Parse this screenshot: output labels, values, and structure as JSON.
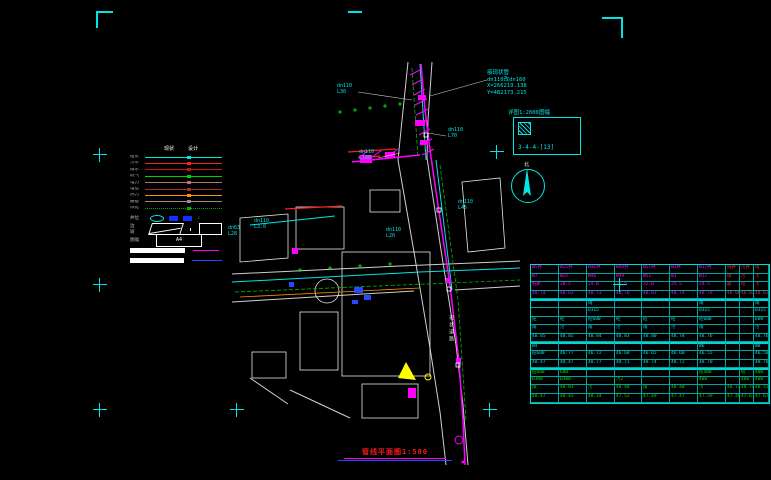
{
  "title": {
    "text": "管线平面图1:500"
  },
  "survey_note": {
    "text": "接现状管\ndn110改dn160\nX=266219.138\nY=482173.215",
    "x": 487,
    "y": 70
  },
  "detail_box": {
    "label": "详图1:2000图幅",
    "code": "3-4-4-[13]"
  },
  "north": {
    "label": "北"
  },
  "colors": {
    "accent": "#00e5e5",
    "pipe_new": "#ff00ff",
    "pipe_existing": "#00e5e5",
    "storm": "#ff2020",
    "green_dashed": "#00b400",
    "table_border": "#00d8d8"
  },
  "annotations": [
    {
      "text": "dn110\nL30",
      "x": 337,
      "y": 84
    },
    {
      "text": "dn110\nL70",
      "x": 448,
      "y": 128
    },
    {
      "text": "dn110\nL190",
      "x": 359,
      "y": 150
    },
    {
      "text": "dn110\nL3.0",
      "x": 254,
      "y": 219
    },
    {
      "text": "dn63\nL28",
      "x": 228,
      "y": 226
    },
    {
      "text": "dn110\nL20",
      "x": 386,
      "y": 228
    },
    {
      "text": "dn110\nL45",
      "x": 458,
      "y": 200
    }
  ],
  "crosses": [
    [
      100,
      155
    ],
    [
      100,
      285
    ],
    [
      100,
      410
    ],
    [
      237,
      410
    ],
    [
      490,
      410
    ],
    [
      620,
      285
    ],
    [
      497,
      152
    ]
  ],
  "road_name": "现状道路",
  "legend": {
    "header": [
      "现状",
      "设计"
    ],
    "line_rows": [
      {
        "label": "给水",
        "color": "#00e5e5",
        "dashed": false
      },
      {
        "label": "污水",
        "color": "#ff2020",
        "dashed": false
      },
      {
        "label": "雨水",
        "color": "#d01010",
        "dashed": false
      },
      {
        "label": "燃气",
        "color": "#00d000",
        "dashed": false
      },
      {
        "label": "电力",
        "color": "#c07070",
        "dashed": false
      },
      {
        "label": "电信",
        "color": "#a03030",
        "dashed": false
      },
      {
        "label": "热力",
        "color": "#ff9000",
        "dashed": false
      },
      {
        "label": "路基",
        "color": "#909090",
        "dashed": false
      },
      {
        "label": "绿化",
        "color": "#00b000",
        "dashed": true
      }
    ],
    "well_row_label": "井位",
    "slope_row_label": "边坡",
    "sheet_row_label": "图幅",
    "a4_label": "A4"
  },
  "table": {
    "cols": [
      28,
      28,
      28,
      27,
      28,
      28,
      28,
      14,
      14,
      15
    ],
    "rows": [
      {
        "k": "m",
        "redFrom": 7,
        "sep": false,
        "cells": [
          "W5井",
          "W25井",
          "W46井",
          "W49井",
          "W51井",
          "W3井",
          "W17井",
          "雨井",
          "污井",
          "雨"
        ]
      },
      {
        "k": "m",
        "redFrom": 7,
        "sep": false,
        "cells": [
          "W7",
          "W25",
          "W46",
          "W49",
          "W51",
          "W3",
          "W17",
          "雨",
          "污",
          "污"
        ]
      },
      {
        "k": "m",
        "redFrom": 7,
        "sep": false,
        "cells": [
          "桩距",
          "28.5",
          "24.0",
          "26.5",
          "22.0",
          "25.5",
          "24.5",
          "最",
          "砼",
          "污"
        ]
      },
      {
        "k": "m",
        "redFrom": 7,
        "sep": false,
        "cells": [
          "48.74",
          "48.63",
          "48.73",
          "48.76",
          "48.81",
          "48.74",
          "48.79",
          "48.08",
          "46.02",
          "48.02"
        ]
      },
      {
        "k": "c",
        "redFrom": -1,
        "sep": true,
        "cells": [
          "",
          "",
          "雨",
          "",
          "",
          "",
          "雨",
          "",
          "",
          "雨"
        ]
      },
      {
        "k": "c",
        "redFrom": -1,
        "sep": false,
        "cells": [
          "",
          "",
          "D315",
          "",
          "",
          "",
          "D315",
          "",
          "",
          "D315"
        ]
      },
      {
        "k": "c",
        "redFrom": -1,
        "sep": false,
        "cells": [
          "砼",
          "砼",
          "砼600",
          "砼",
          "砼",
          "砼",
          "砼600",
          "",
          "",
          "600"
        ]
      },
      {
        "k": "c",
        "redFrom": -1,
        "sep": false,
        "cells": [
          "雨",
          "污",
          "雨",
          "污",
          "雨",
          "污",
          "雨",
          "",
          "",
          "污"
        ]
      },
      {
        "k": "c",
        "redFrom": -1,
        "sep": false,
        "cells": [
          "48.85",
          "48.85",
          "48.84",
          "48.83",
          "48.80",
          "48.78",
          "48.76",
          "",
          "",
          "48.76"
        ]
      },
      {
        "k": "c",
        "redFrom": -1,
        "sep": true,
        "cells": [
          "W4",
          "",
          "",
          "",
          "",
          "",
          "W6",
          "",
          "",
          "W8"
        ]
      },
      {
        "k": "c",
        "redFrom": -1,
        "sep": false,
        "cells": [
          "砼600",
          "46.77",
          "46.72",
          "46.68",
          "46.65",
          "46.60",
          "46.55",
          "",
          "",
          "46.50"
        ]
      },
      {
        "k": "c",
        "redFrom": -1,
        "sep": false,
        "cells": [
          "48.47",
          "48.47",
          "48.77",
          "48.71",
          "48.74",
          "48.72",
          "48.70",
          "",
          "",
          "48.70"
        ]
      },
      {
        "k": "g",
        "redFrom": -1,
        "sep": true,
        "cells": [
          "砼600",
          "600",
          "",
          "",
          "",
          "",
          "砼400",
          "",
          "砼",
          "400"
        ]
      },
      {
        "k": "g",
        "redFrom": -1,
        "sep": false,
        "cells": [
          "D300",
          "D300",
          "",
          "污2",
          "",
          "",
          "400",
          "",
          "400",
          "400"
        ]
      },
      {
        "k": "g",
        "redFrom": -1,
        "sep": false,
        "cells": [
          "雨",
          "48.03",
          "污",
          "48.48",
          "雨",
          "48.40",
          "污",
          "48.72",
          "48.74",
          "48.72"
        ]
      },
      {
        "k": "g",
        "redFrom": -1,
        "sep": false,
        "cells": [
          "48.47",
          "48.42",
          "48.34",
          "47.52",
          "47.49",
          "47.47",
          "47.59",
          "47.46",
          "47.67",
          "47.67"
        ]
      }
    ]
  }
}
